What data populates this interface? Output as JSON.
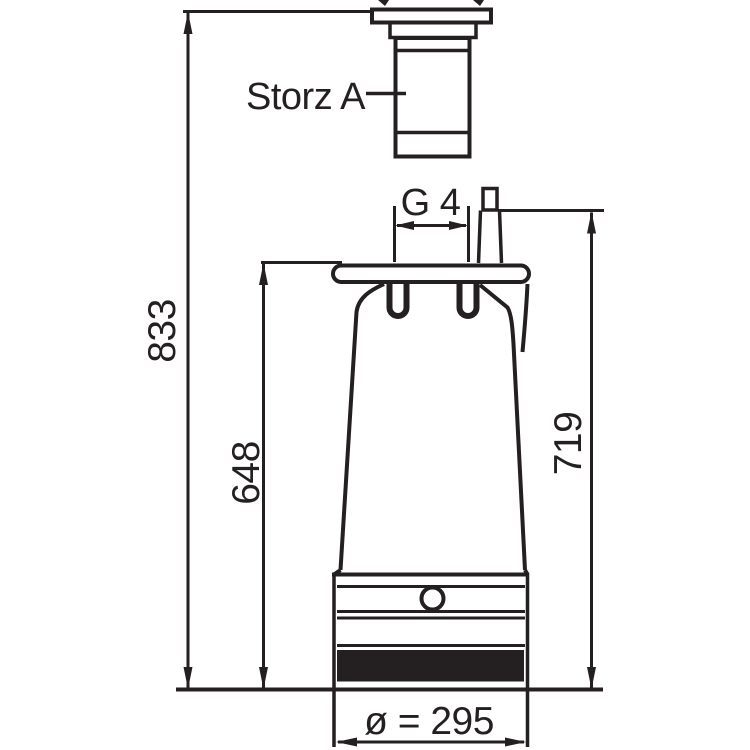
{
  "drawing": {
    "background": "#ffffff",
    "line_color": "#241f21",
    "labels": {
      "coupling": "Storz A",
      "thread": "G 4",
      "total_height": "833",
      "flange_height": "648",
      "right_height": "719",
      "diameter": "ø = 295"
    }
  }
}
